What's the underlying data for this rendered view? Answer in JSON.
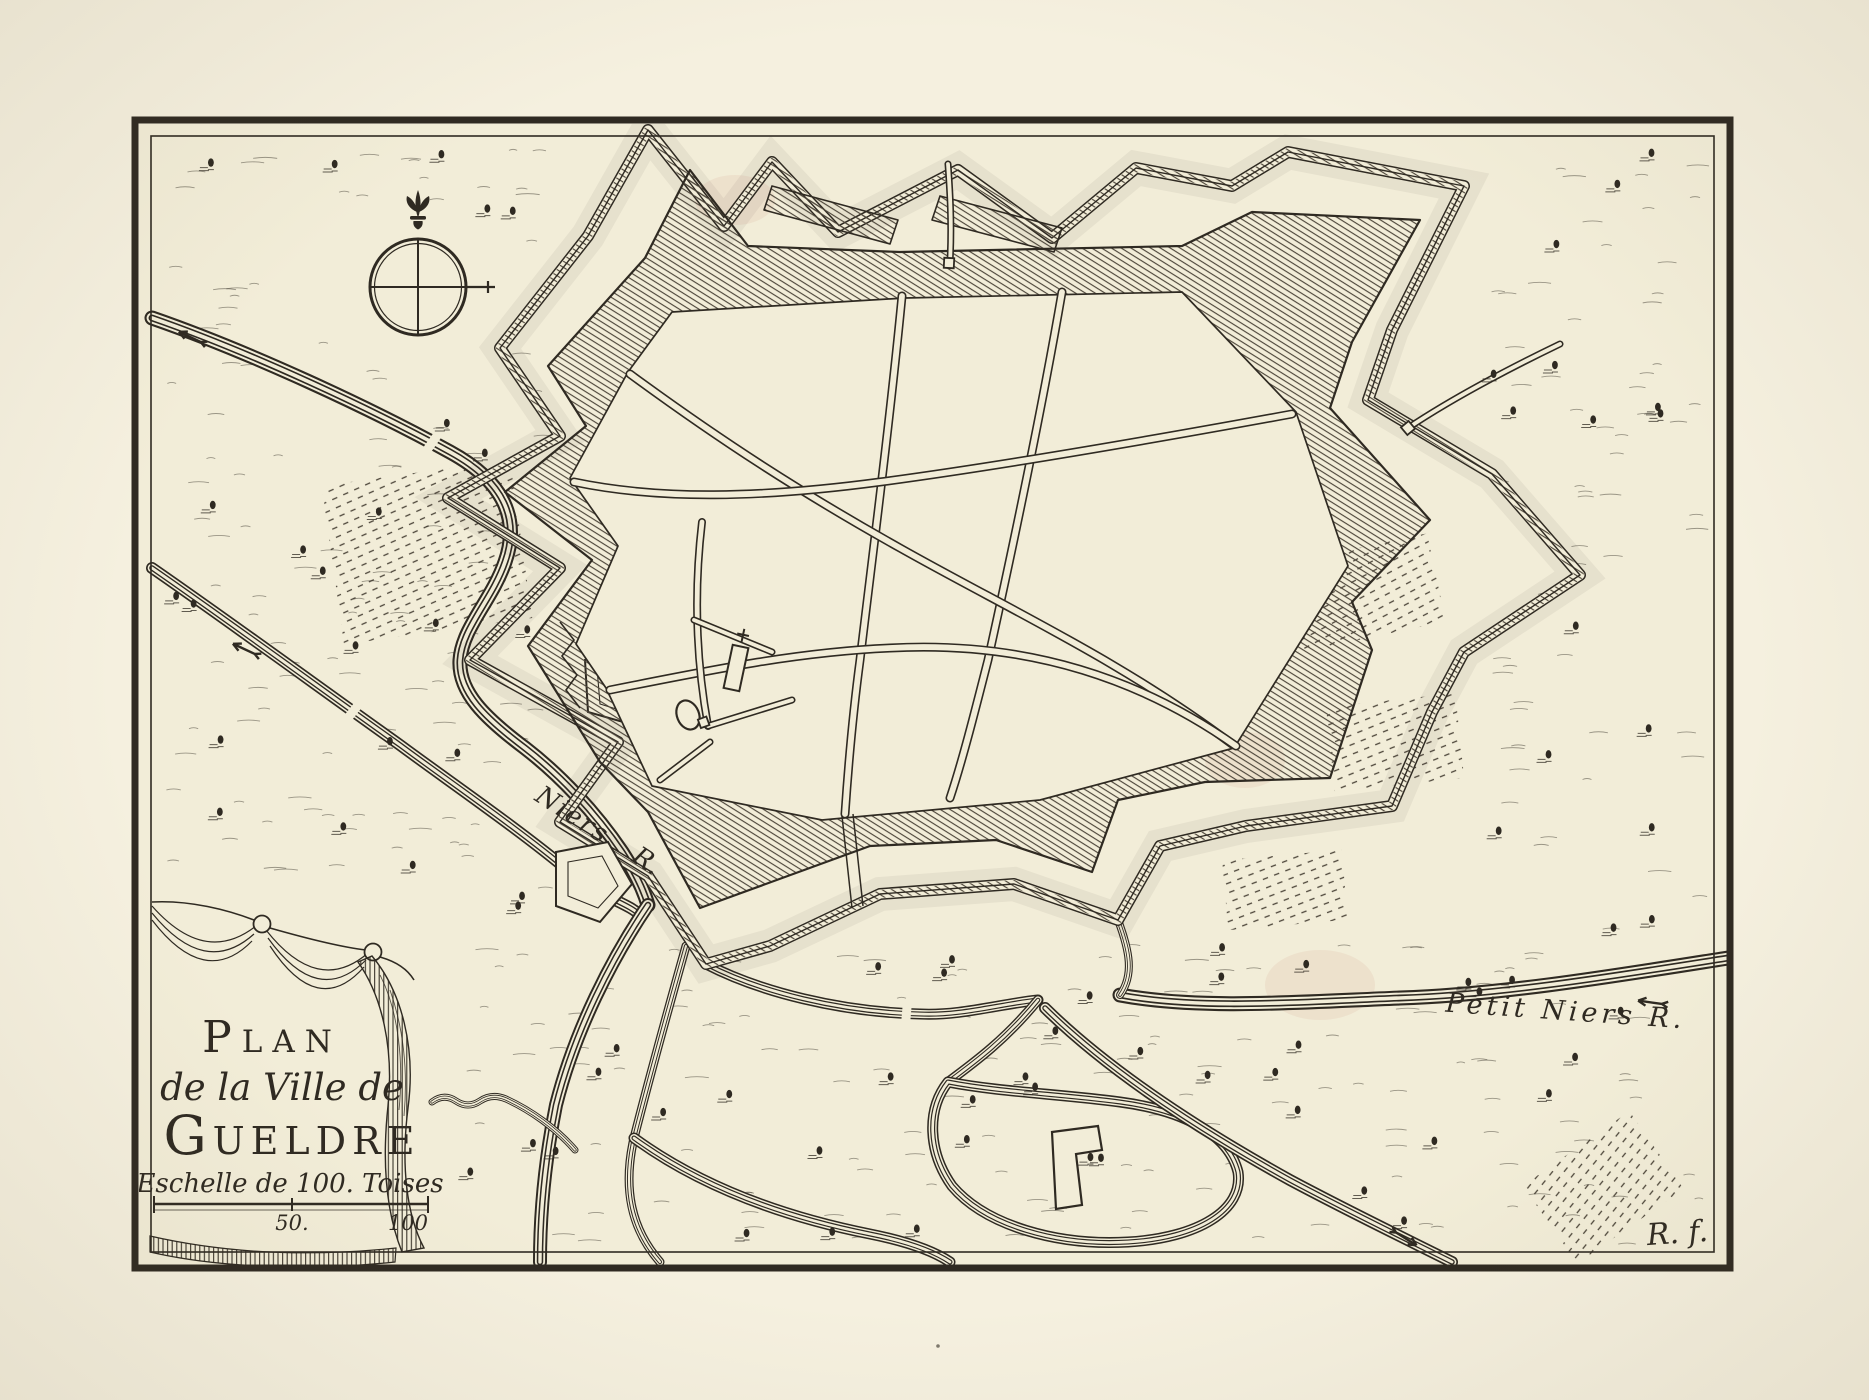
{
  "colors": {
    "paper_margin": "#f5f0df",
    "paper_map": "#f2edd8",
    "ink": "#2f2a22",
    "hatch_ink": "#4d463a"
  },
  "cartouche": {
    "title_line1": "Plan",
    "title_line2": "de la Ville de",
    "title_line3": "Gueldre",
    "scale_label": "Eschelle de 100. Toises",
    "scale_mid_value": "50.",
    "scale_end_value": "100"
  },
  "rivers": {
    "main_name": "Niers",
    "main_abbr": "R.",
    "petit_label": "Petit Niers R."
  },
  "signature": "R. f.",
  "compass": {
    "north_symbol": "fleur-de-lis",
    "style": "circle-with-cross"
  }
}
